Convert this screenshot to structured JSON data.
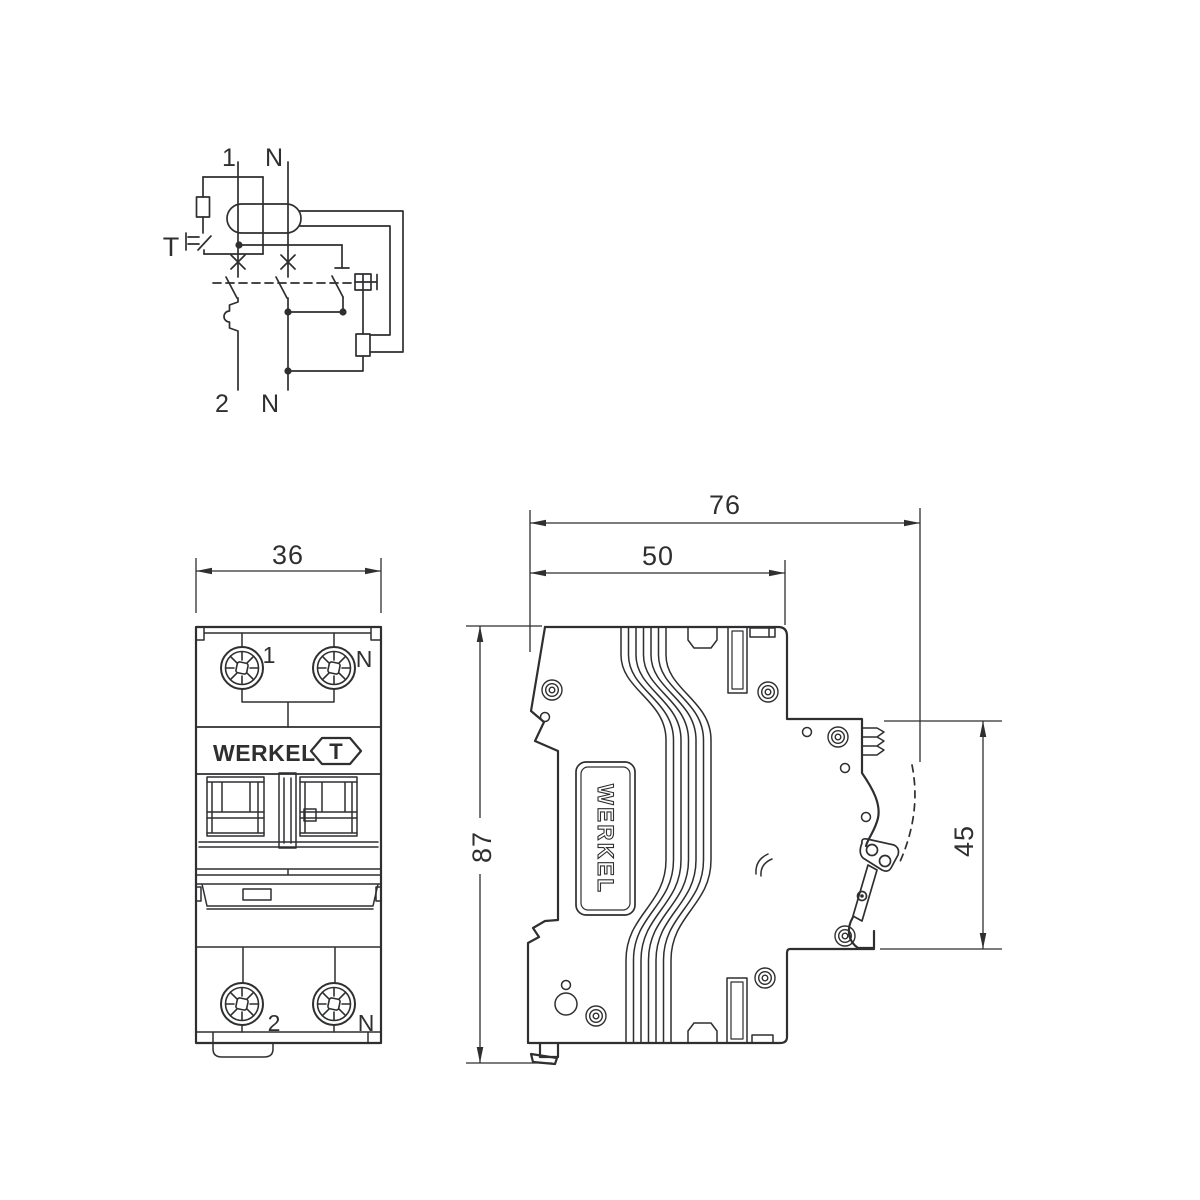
{
  "colors": {
    "ink": "#2e2f31",
    "background": "#ffffff"
  },
  "schematic": {
    "line1_label": "1",
    "neutral_top_label": "N",
    "test_button_label": "T",
    "line2_label": "2",
    "neutral_bottom_label": "N"
  },
  "front_view": {
    "dim_width": "36",
    "terminal_1": "1",
    "terminal_n_top": "N",
    "brand": "WERKEL",
    "test_button": "T",
    "terminal_2": "2",
    "terminal_n_bottom": "N"
  },
  "side_view": {
    "dim_depth_total": "76",
    "dim_depth_body": "50",
    "dim_height": "87",
    "dim_front_height": "45",
    "brand": "WERKEL"
  }
}
